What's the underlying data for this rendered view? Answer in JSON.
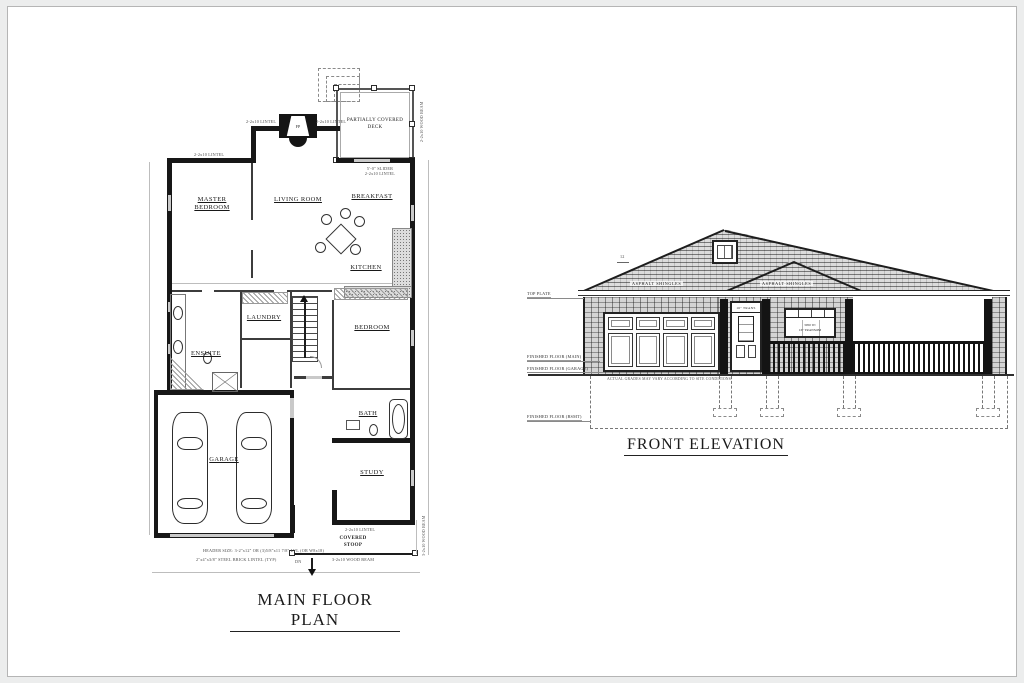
{
  "plan": {
    "title": "MAIN FLOOR PLAN",
    "rooms": {
      "master_bedroom": "MASTER BEDROOM",
      "living_room": "LIVING ROOM",
      "breakfast": "BREAKFAST",
      "kitchen": "KITCHEN",
      "laundry": "LAUNDRY",
      "ensuite": "ENSUITE",
      "bedroom": "BEDROOM",
      "bath": "BATH",
      "garage": "GARAGE",
      "study": "STUDY",
      "deck": "PARTIALLY COVERED DECK",
      "stoop": "COVERED STOOP"
    },
    "marks": {
      "fireplace": "FP",
      "down": "DN"
    },
    "notes": {
      "lintel": "2-2x10 LINTEL",
      "slider": "5'-0\" SLIDER",
      "deck_beam": "2-2x10 WOOD BEAM",
      "stoop_beam": "3-2x10 WOOD BEAM",
      "header": "HEADER SIZE: 3-2\"x12\" OR (3)5/8\"x11 7/8\" LVL (OR W8x18)",
      "steel": "2\"x4\"x3/8\" STEEL BRICK LINTEL (TYP)"
    }
  },
  "elevation": {
    "title": "FRONT ELEVATION",
    "levels": {
      "top_plate": "TOP PLATE",
      "ff_main": "FINISHED FLOOR (MAIN)",
      "ff_garage": "FINISHED FLOOR (GARAGE)",
      "ff_bsmt": "FINISHED FLOOR (BSMT)"
    },
    "shingles": "ASPHALT SHINGLES",
    "pitch": "12",
    "door_transom": "16\" TRANS",
    "window_line1": "3050 W/",
    "window_line2": "16\" TRANSOM",
    "grade_note": "ACTUAL GRADES MAY VARY ACCORDING TO SITE CONDITIONS."
  },
  "colors": {
    "ink": "#171717",
    "paper": "#ffffff",
    "frame": "#b5b5b5"
  }
}
